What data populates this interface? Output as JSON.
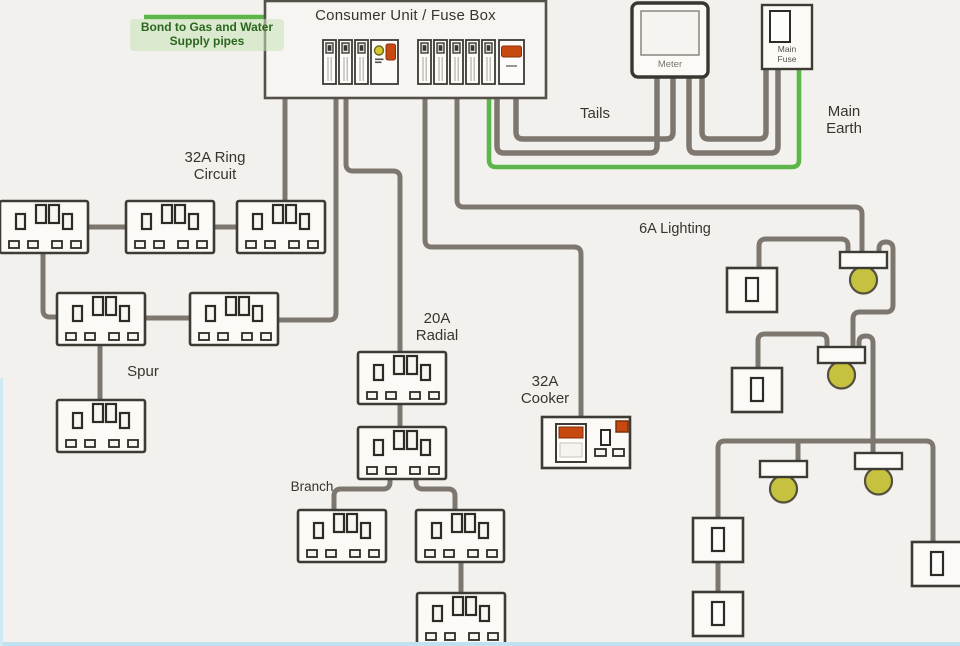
{
  "diagram": {
    "title": "Consumer Unit / Fuse Box",
    "labels": {
      "bond": "Bond to Gas and Water\nSupply pipes",
      "tails": "Tails",
      "main_earth": "Main\nEarth",
      "ring_circuit": "32A Ring\nCircuit",
      "spur": "Spur",
      "radial": "20A\nRadial",
      "branch": "Branch",
      "cooker": "32A\nCooker",
      "lighting": "6A Lighting",
      "meter": "Meter",
      "main_fuse": "Main\nFuse"
    },
    "colors": {
      "background": "#f3f1ed",
      "wire_gray": "#7d7770",
      "earth_green": "#5db64a",
      "bulb_olive": "#c6c23f",
      "accent_orange": "#c8490f",
      "indicator_yellow": "#d3ca2e",
      "text": "#38352f",
      "bond_text": "#2b661f"
    },
    "components": {
      "breakers_left_group": 3,
      "breakers_right_group": 5,
      "double_sockets": 11,
      "light_switches": 5,
      "ceiling_lights": 4,
      "cooker_units": 1,
      "meters": 1,
      "main_fuses": 1
    }
  }
}
